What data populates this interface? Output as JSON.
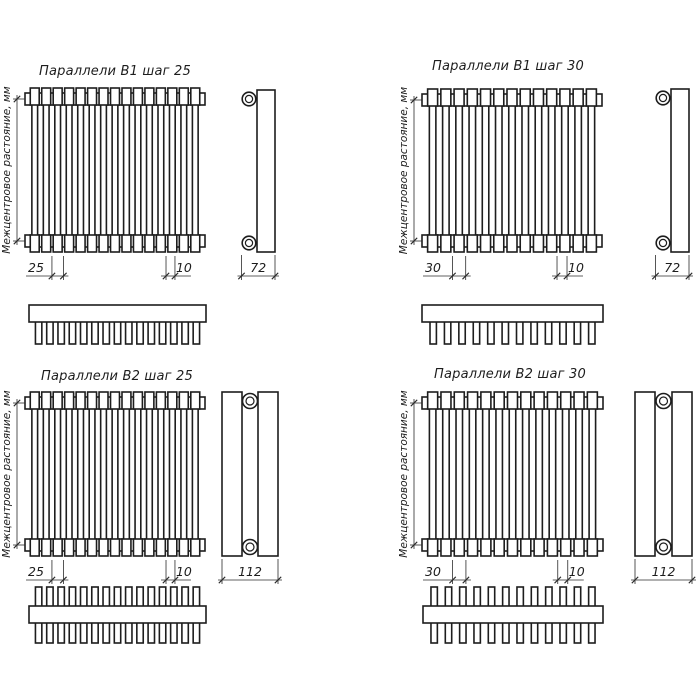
{
  "axis_label": "Межцентровое растояние, мм",
  "colors": {
    "line": "#1d1d1d",
    "background": "#ffffff"
  },
  "drawings": [
    {
      "title": "Параллели В1 шаг 25",
      "variant": "B1",
      "step": "25",
      "tube_width": "10",
      "depth": "72",
      "front_tube_count": 15,
      "top_tube_count": 15,
      "rows": 1
    },
    {
      "title": "Параллели В1 шаг 30",
      "variant": "B1",
      "step": "30",
      "tube_width": "10",
      "depth": "72",
      "front_tube_count": 13,
      "top_tube_count": 12,
      "rows": 1
    },
    {
      "title": "Параллели В2 шаг 25",
      "variant": "B2",
      "step": "25",
      "tube_width": "10",
      "depth": "112",
      "front_tube_count": 15,
      "top_tube_count": 15,
      "rows": 2
    },
    {
      "title": "Параллели В2 шаг 30",
      "variant": "B2",
      "step": "30",
      "tube_width": "10",
      "depth": "112",
      "front_tube_count": 13,
      "top_tube_count": 12,
      "rows": 2
    }
  ]
}
